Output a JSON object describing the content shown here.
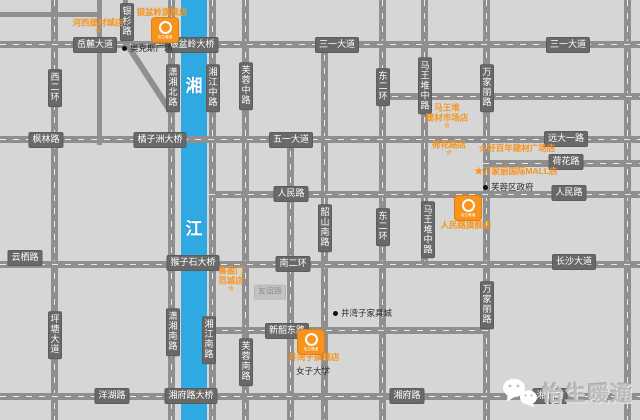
{
  "colors": {
    "accent_orange": "#f7941d",
    "river_blue": "#2fa9e1",
    "road_gray": "#8f8f8f",
    "label_bg": "#696969",
    "background": "#d6d6d6",
    "watermark_gray": "#bdbdbd"
  },
  "river": {
    "char_top": "湘",
    "char_bottom": "江"
  },
  "road_labels": [
    {
      "text": "岳麓大道",
      "dir": "h",
      "x": 95,
      "y": 45
    },
    {
      "text": "银盆岭大桥",
      "dir": "h",
      "x": 192,
      "y": 45
    },
    {
      "text": "三一大道",
      "dir": "h",
      "x": 337,
      "y": 45
    },
    {
      "text": "三一大道",
      "dir": "h",
      "x": 568,
      "y": 45
    },
    {
      "text": "枫林路",
      "dir": "h",
      "x": 46,
      "y": 140
    },
    {
      "text": "橘子洲大桥",
      "dir": "h",
      "x": 160,
      "y": 140
    },
    {
      "text": "五一大道",
      "dir": "h",
      "x": 291,
      "y": 140
    },
    {
      "text": "远大一路",
      "dir": "h",
      "x": 566,
      "y": 139
    },
    {
      "text": "荷花路",
      "dir": "h",
      "x": 566,
      "y": 162
    },
    {
      "text": "人民路",
      "dir": "h",
      "x": 291,
      "y": 194
    },
    {
      "text": "人民路",
      "dir": "h",
      "x": 569,
      "y": 193
    },
    {
      "text": "云栖路",
      "dir": "h",
      "x": 25,
      "y": 258
    },
    {
      "text": "猴子石大桥",
      "dir": "h",
      "x": 193,
      "y": 263
    },
    {
      "text": "南二环",
      "dir": "h",
      "x": 293,
      "y": 264
    },
    {
      "text": "长沙大道",
      "dir": "h",
      "x": 574,
      "y": 262
    },
    {
      "text": "新韶东路",
      "dir": "h",
      "x": 287,
      "y": 331
    },
    {
      "text": "洋湖路",
      "dir": "h",
      "x": 112,
      "y": 396
    },
    {
      "text": "湘府路大桥",
      "dir": "h",
      "x": 191,
      "y": 396
    },
    {
      "text": "湘府路",
      "dir": "h",
      "x": 407,
      "y": 396
    },
    {
      "text": "湘府路",
      "dir": "h",
      "x": 550,
      "y": 396
    },
    {
      "text": "西二环",
      "dir": "v",
      "x": 55,
      "y": 88
    },
    {
      "text": "银杉路",
      "dir": "v",
      "x": 127,
      "y": 22
    },
    {
      "text": "潇湘北路",
      "dir": "v",
      "x": 173,
      "y": 88
    },
    {
      "text": "湘江中路",
      "dir": "v",
      "x": 213,
      "y": 88
    },
    {
      "text": "芙蓉中路",
      "dir": "v",
      "x": 246,
      "y": 86
    },
    {
      "text": "东二环",
      "dir": "v",
      "x": 383,
      "y": 87
    },
    {
      "text": "马王堆中路",
      "dir": "v",
      "x": 425,
      "y": 86
    },
    {
      "text": "万家丽路",
      "dir": "v",
      "x": 487,
      "y": 88
    },
    {
      "text": "东二环",
      "dir": "v",
      "x": 383,
      "y": 227
    },
    {
      "text": "韶山南路",
      "dir": "v",
      "x": 325,
      "y": 228
    },
    {
      "text": "马王堆中路",
      "dir": "v",
      "x": 428,
      "y": 230
    },
    {
      "text": "万家丽路",
      "dir": "v",
      "x": 487,
      "y": 305
    },
    {
      "text": "潇湘南路",
      "dir": "v",
      "x": 173,
      "y": 332
    },
    {
      "text": "湘江南路",
      "dir": "v",
      "x": 209,
      "y": 340
    },
    {
      "text": "芙蓉南路",
      "dir": "v",
      "x": 246,
      "y": 362
    },
    {
      "text": "坪塘大道",
      "dir": "v",
      "x": 55,
      "y": 335
    }
  ],
  "minor_labels": [
    {
      "text": "友谊路",
      "x": 270,
      "y": 292
    }
  ],
  "pois": [
    {
      "text": "奥克斯广场",
      "x": 122,
      "y": 48,
      "dot": true
    },
    {
      "text": "芙蓉区政府",
      "x": 483,
      "y": 187,
      "dot": true
    },
    {
      "text": "井湾子家具城",
      "x": 333,
      "y": 313,
      "dot": true
    },
    {
      "text": "女子大学",
      "x": 296,
      "y": 371,
      "dot": false
    }
  ],
  "stores": [
    {
      "lines": [
        "河西建材城店"
      ],
      "star": "below",
      "x": 98,
      "y": 26
    },
    {
      "lines": [
        "银盆岭旗舰店"
      ],
      "star": "none",
      "x": 162,
      "y": 12
    },
    {
      "lines": [
        "马王堆",
        "建材市场店"
      ],
      "star": "below",
      "x": 447,
      "y": 116
    },
    {
      "lines": [
        "荷花路店"
      ],
      "star": "below",
      "x": 449,
      "y": 148
    },
    {
      "lines": [
        "☆好百年建材广场店"
      ],
      "star": "none",
      "x": 517,
      "y": 148
    },
    {
      "lines": [
        "★万家丽国际MALL店"
      ],
      "star": "none",
      "x": 516,
      "y": 171
    },
    {
      "lines": [
        "人民路旗舰店"
      ],
      "star": "none",
      "x": 466,
      "y": 225
    },
    {
      "lines": [
        "喜盈门",
        "范城店"
      ],
      "star": "below",
      "x": 231,
      "y": 279
    },
    {
      "lines": [
        "井湾子旗舰店"
      ],
      "star": "none",
      "x": 314,
      "y": 357
    }
  ],
  "logos": {
    "label": "怡生暖通",
    "items": [
      {
        "x": 152,
        "y": 18
      },
      {
        "x": 455,
        "y": 196
      },
      {
        "x": 298,
        "y": 330
      }
    ]
  },
  "watermark": {
    "brand": "怡生暖通",
    "icon": "wechat-icon"
  }
}
